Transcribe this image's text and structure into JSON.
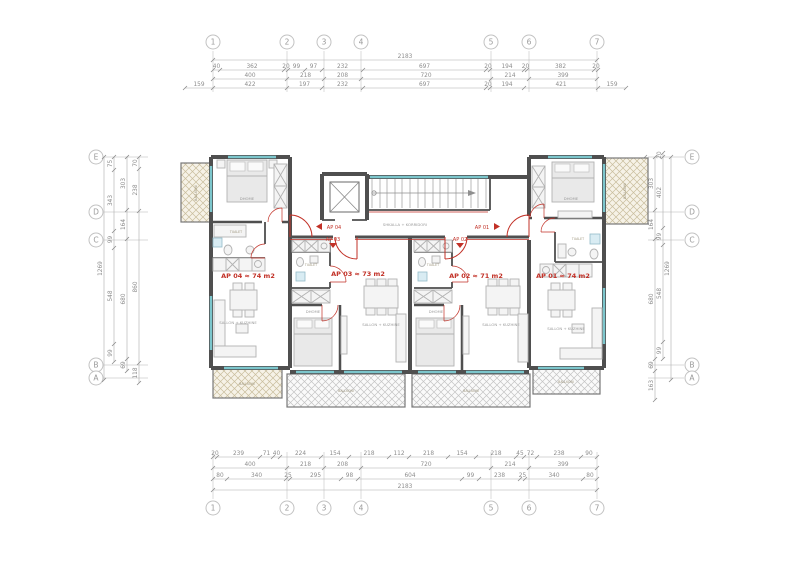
{
  "drawing": {
    "apartments": [
      {
        "id": "ap04",
        "entry_label": "AP 04",
        "area_label": "AP 04 ≈ 74 m2"
      },
      {
        "id": "ap03",
        "entry_label": "AP 03",
        "area_label": "AP 03 ≈ 73 m2"
      },
      {
        "id": "ap02",
        "entry_label": "AP 02",
        "area_label": "AP 02 ≈ 71 m2"
      },
      {
        "id": "ap01",
        "entry_label": "AP 01",
        "area_label": "AP 01 ≈ 74 m2"
      }
    ],
    "room_labels": {
      "bedroom": "DHOME",
      "living": "SALLON + KUZHINE",
      "balcony": "BALLKONI",
      "bath": "TUALET",
      "corridor": "SHKALLA + KORRIDORI"
    }
  },
  "colors": {
    "wall": "#4f4f4f",
    "window": "#7cc6cc",
    "door_red": "#c23127",
    "dim_gray": "#8c8c8c",
    "hatch_tan": "#c9bd9c",
    "hatch_gray": "#c4c4c4"
  },
  "grid": {
    "top": {
      "axis": "x",
      "circle_at": 42,
      "line": [
        51,
        92
      ],
      "items": [
        {
          "label": "1",
          "pos": 213
        },
        {
          "label": "2",
          "pos": 287
        },
        {
          "label": "3",
          "pos": 324
        },
        {
          "label": "4",
          "pos": 361
        },
        {
          "label": "5",
          "pos": 491
        },
        {
          "label": "6",
          "pos": 529
        },
        {
          "label": "7",
          "pos": 597
        }
      ]
    },
    "bottom": {
      "axis": "x",
      "circle_at": 508,
      "line": [
        452,
        499
      ],
      "items": [
        {
          "label": "1",
          "pos": 213
        },
        {
          "label": "2",
          "pos": 287
        },
        {
          "label": "3",
          "pos": 324
        },
        {
          "label": "4",
          "pos": 361
        },
        {
          "label": "5",
          "pos": 491
        },
        {
          "label": "6",
          "pos": 529
        },
        {
          "label": "7",
          "pos": 597
        }
      ]
    },
    "left": {
      "axis": "y",
      "circle_at": 96,
      "line": [
        104,
        148
      ],
      "items": [
        {
          "label": "E",
          "pos": 157
        },
        {
          "label": "D",
          "pos": 212
        },
        {
          "label": "C",
          "pos": 240
        },
        {
          "label": "B",
          "pos": 365
        },
        {
          "label": "A",
          "pos": 378
        }
      ]
    },
    "right": {
      "axis": "y",
      "circle_at": 692,
      "line": [
        648,
        684
      ],
      "items": [
        {
          "label": "E",
          "pos": 157
        },
        {
          "label": "D",
          "pos": 212
        },
        {
          "label": "C",
          "pos": 240
        },
        {
          "label": "B",
          "pos": 365
        },
        {
          "label": "A",
          "pos": 378
        }
      ]
    }
  },
  "dimensions": {
    "chains": [
      {
        "name": "top-total",
        "orient": "h",
        "at": 60,
        "ticks": [
          213,
          597
        ],
        "labels": [
          "2183"
        ]
      },
      {
        "name": "top-row1",
        "orient": "h",
        "at": 70,
        "ticks": [
          213,
          220,
          284,
          288,
          305,
          322,
          363,
          486,
          490,
          524,
          527,
          594,
          598
        ],
        "labels": [
          "40",
          "362",
          "20",
          "99",
          "97",
          "232",
          "697",
          "20",
          "194",
          "20",
          "382",
          "20"
        ]
      },
      {
        "name": "top-row2",
        "orient": "h",
        "at": 79,
        "ticks": [
          213,
          287,
          324,
          361,
          491,
          529,
          597
        ],
        "labels": [
          "400",
          "218",
          "208",
          "720",
          "214",
          "399"
        ]
      },
      {
        "name": "top-row3",
        "orient": "h",
        "at": 88,
        "ticks": [
          185,
          213,
          287,
          322,
          363,
          486,
          490,
          524,
          598,
          626
        ],
        "labels": [
          "159",
          "422",
          "197",
          "232",
          "697",
          "20",
          "194",
          "421",
          "159"
        ]
      },
      {
        "name": "bot-row1",
        "orient": "h",
        "at": 457,
        "ticks": [
          213,
          217,
          260,
          273,
          280,
          321,
          349,
          389,
          409,
          448,
          476,
          516,
          524,
          537,
          581,
          597
        ],
        "labels": [
          "20",
          "239",
          "71",
          "40",
          "224",
          "154",
          "218",
          "112",
          "218",
          "154",
          "218",
          "45",
          "72",
          "238",
          "90"
        ]
      },
      {
        "name": "bot-row2",
        "orient": "h",
        "at": 468,
        "ticks": [
          213,
          287,
          324,
          361,
          491,
          529,
          597
        ],
        "labels": [
          "400",
          "218",
          "208",
          "720",
          "214",
          "399"
        ]
      },
      {
        "name": "bot-row3",
        "orient": "h",
        "at": 479,
        "ticks": [
          213,
          227,
          286,
          290,
          341,
          358,
          462,
          479,
          520,
          525,
          583,
          597
        ],
        "labels": [
          "80",
          "340",
          "25",
          "295",
          "98",
          "604",
          "99",
          "238",
          "25",
          "340",
          "80"
        ]
      },
      {
        "name": "bot-total",
        "orient": "h",
        "at": 490,
        "ticks": [
          213,
          597
        ],
        "labels": [
          "2183"
        ]
      },
      {
        "name": "left-c1",
        "orient": "v",
        "at": 139,
        "ticks": [
          157,
          169,
          211,
          363,
          383
        ],
        "labels": [
          "70",
          "238",
          "860",
          "118"
        ]
      },
      {
        "name": "left-c2",
        "orient": "v",
        "at": 127,
        "ticks": [
          157,
          210,
          239,
          359,
          371
        ],
        "labels": [
          "303",
          "164",
          "680",
          "69"
        ]
      },
      {
        "name": "left-c3",
        "orient": "v",
        "at": 114,
        "ticks": [
          157,
          170,
          231,
          248,
          344,
          362
        ],
        "labels": [
          "75",
          "343",
          "99",
          "548",
          "99"
        ]
      },
      {
        "name": "left-total",
        "orient": "v",
        "at": 104,
        "ticks": [
          157,
          380
        ],
        "labels": [
          "1269"
        ]
      },
      {
        "name": "right-c1",
        "orient": "v",
        "at": 645,
        "ticks": [
          157,
          169,
          211
        ],
        "labels": [
          "70",
          "238"
        ]
      },
      {
        "name": "right-c2",
        "orient": "v",
        "at": 655,
        "ticks": [
          157,
          210,
          239,
          359,
          371,
          400
        ],
        "labels": [
          "303",
          "164",
          "680",
          "69",
          "163"
        ]
      },
      {
        "name": "right-c3",
        "orient": "v",
        "at": 663,
        "ticks": [
          153,
          157,
          228,
          245,
          342,
          359
        ],
        "labels": [
          "20",
          "402",
          "99",
          "548",
          "99"
        ]
      },
      {
        "name": "right-total",
        "orient": "v",
        "at": 671,
        "ticks": [
          157,
          380
        ],
        "labels": [
          "1269"
        ]
      }
    ]
  }
}
